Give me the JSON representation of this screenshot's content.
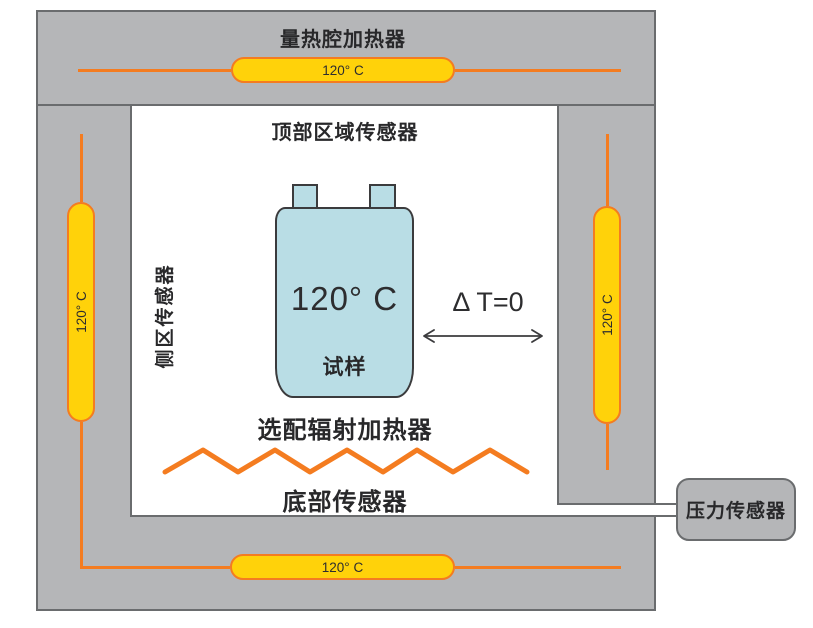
{
  "diagram": {
    "title_note": "battery calorimeter chamber schematic",
    "labels": {
      "chamber_heater": "量热腔加热器",
      "top_zone_sensor": "顶部区域传感器",
      "side_zone_sensor": "侧区传感器",
      "optional_radiant_heater": "选配辐射加热器",
      "bottom_sensor": "底部传感器",
      "pressure_sensor": "压力传感器",
      "delta_t": "Δ T=0"
    },
    "heaters": {
      "top": {
        "temperature": "120° C"
      },
      "bottom": {
        "temperature": "120° C"
      },
      "left": {
        "temperature": "120° C"
      },
      "right": {
        "temperature": "120° C"
      }
    },
    "specimen": {
      "temperature": "120° C",
      "label": "试样"
    },
    "colors": {
      "frame_gray": "#b5b6b8",
      "frame_border_gray": "#6a6c6e",
      "heater_yellow": "#ffd20a",
      "heater_orange": "#f47c20",
      "cell_blue": "#b9dde5",
      "text_dark": "#28282a"
    }
  }
}
